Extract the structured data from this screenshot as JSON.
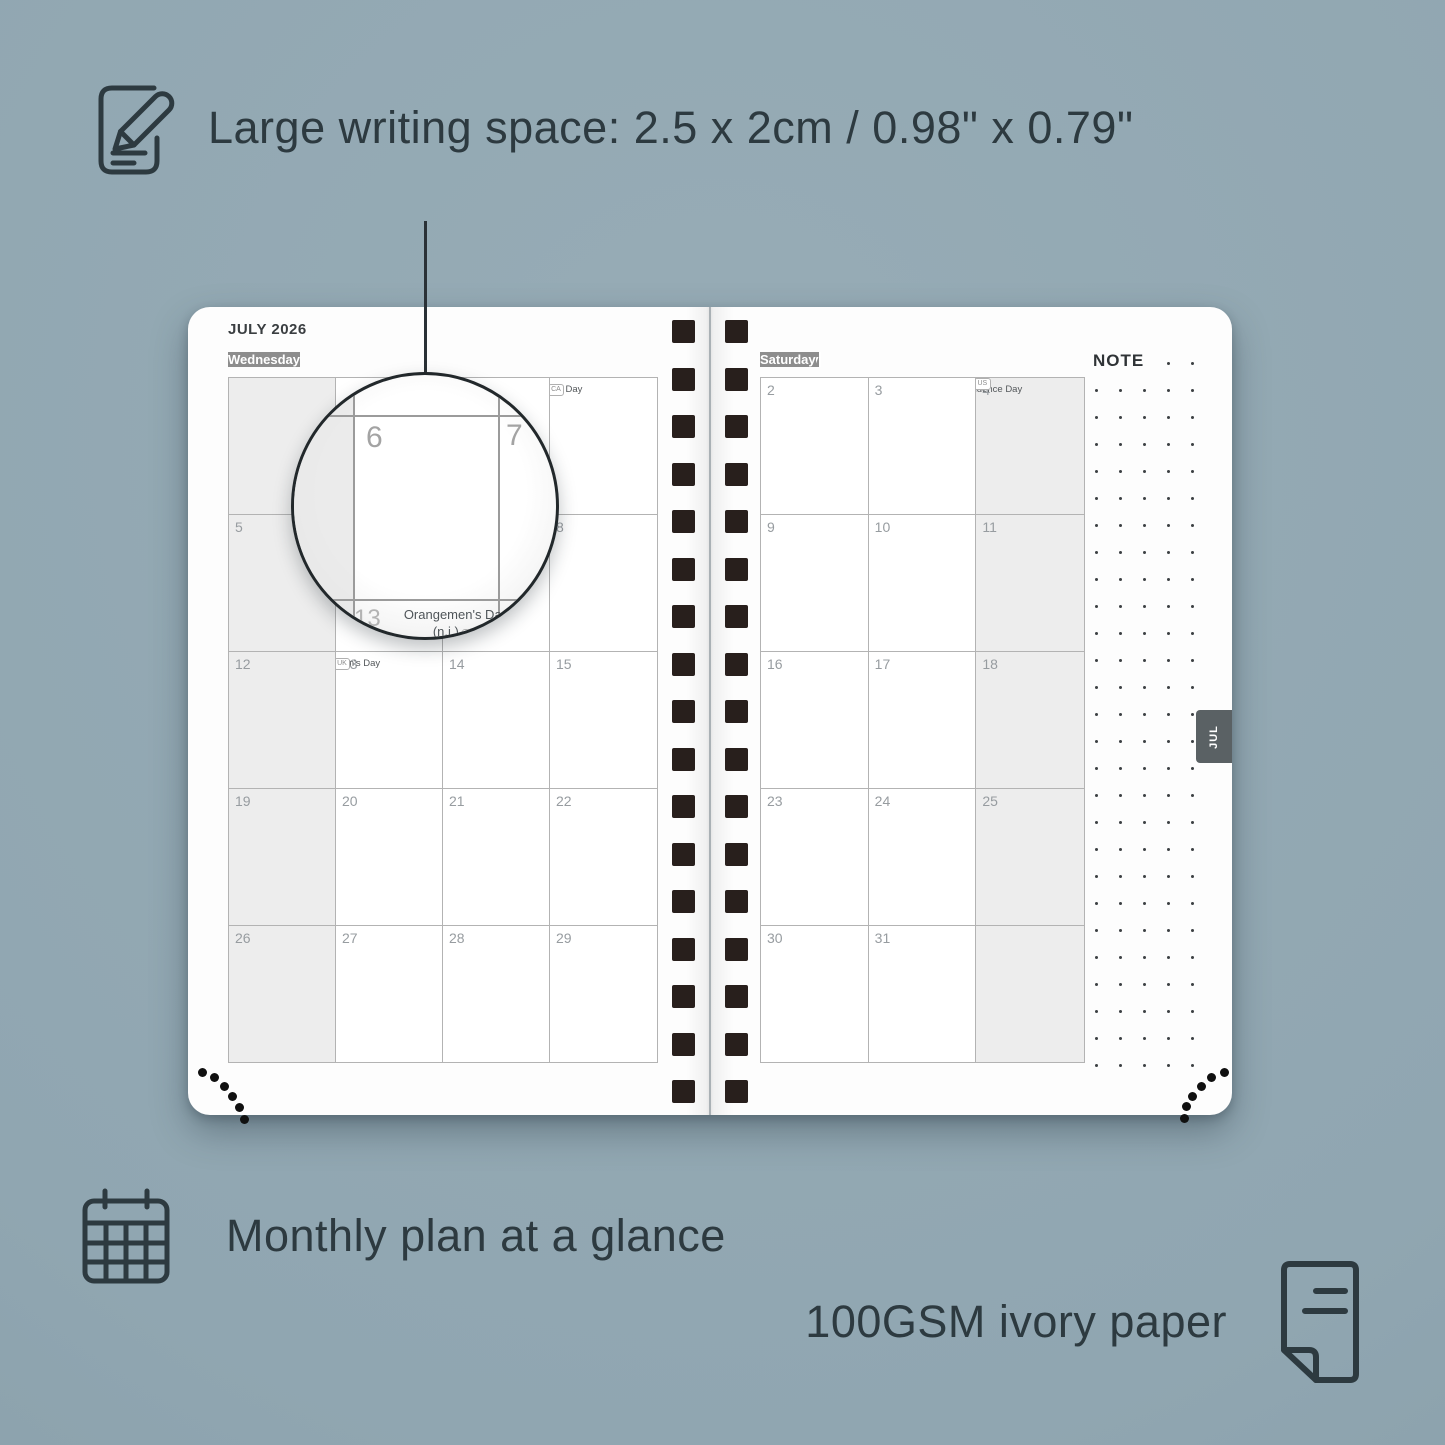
{
  "colors": {
    "text_dark": "#2d3a40",
    "page_bg": "#fdfdfd",
    "header_bg": "#8d8d8d",
    "header_text": "#ffffff",
    "cell_shaded": "#ededed",
    "grid_line": "#b3b3b3",
    "day_number": "#979ca0",
    "holiday_text": "#53575a",
    "spiral_square": "#281f1c",
    "tab_bg": "#5a6164"
  },
  "callouts": {
    "writing_space": "Large writing space: 2.5 x 2cm / 0.98\" x 0.79\"",
    "monthly_plan": "Monthly plan at a glance",
    "paper": "100GSM ivory paper"
  },
  "planner": {
    "month_title": "JULY 2026",
    "note_label": "NOTE",
    "month_tab": "JUL",
    "left_headers": [
      "Sunday",
      "Monday",
      "Tuesday",
      "Wednesday"
    ],
    "right_headers": [
      "Thursday",
      "Friday",
      "Saturday"
    ],
    "left_rows": [
      [
        {
          "day": ""
        },
        {
          "day": ""
        },
        {
          "day": ""
        },
        {
          "day": "1",
          "holiday": "Canada Day",
          "badge": "CA",
          "badge_on_line2": false
        }
      ],
      [
        {
          "day": "5"
        },
        {
          "day": "6"
        },
        {
          "day": "7"
        },
        {
          "day": "8"
        }
      ],
      [
        {
          "day": "12"
        },
        {
          "day": "13",
          "holiday": "Orangemen's Day",
          "line2": "(n.i.)",
          "badge": "UK",
          "badge_on_line2": true
        },
        {
          "day": "14"
        },
        {
          "day": "15"
        }
      ],
      [
        {
          "day": "19"
        },
        {
          "day": "20"
        },
        {
          "day": "21"
        },
        {
          "day": "22"
        }
      ],
      [
        {
          "day": "26"
        },
        {
          "day": "27"
        },
        {
          "day": "28"
        },
        {
          "day": "29"
        }
      ]
    ],
    "right_rows": [
      [
        {
          "day": "2"
        },
        {
          "day": "3"
        },
        {
          "day": "4",
          "holiday": "Independence Day",
          "badge": "US",
          "badge_on_line2": true
        }
      ],
      [
        {
          "day": "9"
        },
        {
          "day": "10"
        },
        {
          "day": "11"
        }
      ],
      [
        {
          "day": "16"
        },
        {
          "day": "17"
        },
        {
          "day": "18"
        }
      ],
      [
        {
          "day": "23"
        },
        {
          "day": "24"
        },
        {
          "day": "25"
        }
      ],
      [
        {
          "day": "30"
        },
        {
          "day": "31"
        },
        {
          "day": ""
        }
      ]
    ],
    "magnifier": {
      "top_left_day": "6",
      "top_right_day": "7",
      "bottom_day": "13",
      "bottom_holiday": "Orangemen's Day",
      "bottom_note": "(n.i.)",
      "bottom_badge": "UK"
    }
  }
}
